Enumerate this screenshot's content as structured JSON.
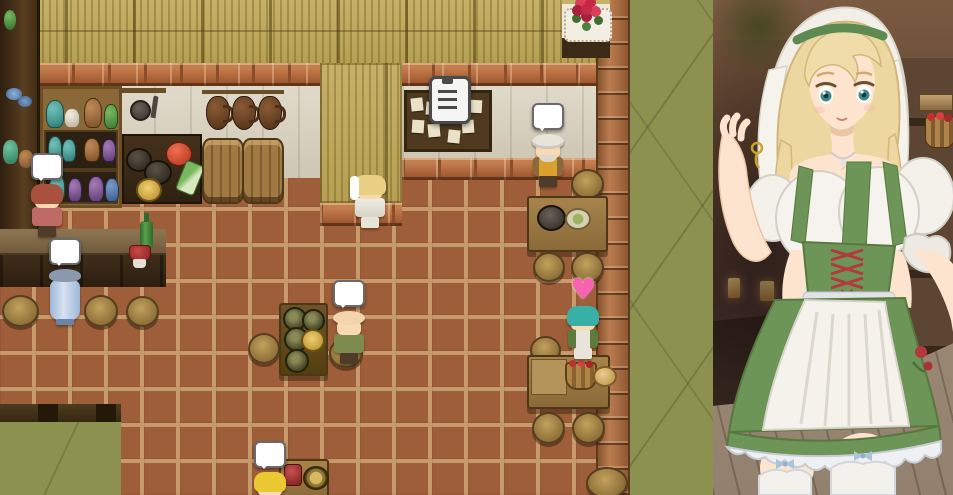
{
  "scene": {
    "description": "RPG Maker style tavern interior map with anime barmaid portrait overlay on the right",
    "viewport": {
      "width": 953,
      "height": 495
    }
  },
  "palette": {
    "floor": "#9e5e39",
    "floor-grout": "#c79a6b",
    "green-area": "#8d914f",
    "straw": "#c6b168",
    "brick-dark": "#8a4e2c",
    "bubble-fill": "#ffffff",
    "bubble-border": "#6a6a6a",
    "heart": "#f763ae",
    "portrait-bg-top": "#7a5a40",
    "portrait-bg-mid": "#46302a",
    "portrait-floor": "#93816f"
  },
  "indicators": {
    "heart_glyph": "♥",
    "speech_bubble_count": 5,
    "heart_count": 1
  },
  "characters": [
    {
      "id": "shopkeeper",
      "desc": "red-haired shopkeeper by the wall shelves",
      "hair": "#a9513f",
      "outfit": "#bf6a64",
      "indicator": "speech-bubble"
    },
    {
      "id": "blue-patron",
      "desc": "patron in light blue robe standing at the bar counter",
      "hair": "#8a9aac",
      "outfit": "#9cb6d8",
      "indicator": "speech-bubble"
    },
    {
      "id": "player-maid",
      "desc": "blonde maid player character with white veil",
      "hair": "#e9d084",
      "outfit": "#efece3",
      "indicator": "none"
    },
    {
      "id": "old-man",
      "desc": "old man with white turban and yellow vest at dining table",
      "hair": "#e9e5da",
      "outfit": "#d9a02e",
      "indicator": "speech-bubble"
    },
    {
      "id": "bald-patron",
      "desc": "bald patron in green sitting at keg table",
      "hair": "#f0cfa6",
      "outfit": "#7d8c4e",
      "indicator": "speech-bubble"
    },
    {
      "id": "teal-adventurer",
      "desc": "teal-haired adventurer in green armor with apron",
      "hair": "#39b0a6",
      "outfit": "#5d7c3c",
      "indicator": "heart"
    },
    {
      "id": "blonde-kid",
      "desc": "blonde child in red at bottom table",
      "hair": "#e9c832",
      "outfit": "#c24242",
      "indicator": "speech-bubble"
    }
  ],
  "map_props": [
    "bulletin-board",
    "quest-note-icon",
    "rose-bouquet-table",
    "bar-counter",
    "wine-bottle",
    "red-cup",
    "wooden-stools",
    "dining-table-with-pot-and-bowl",
    "keg-table-with-gold-plate",
    "table-with-apple-basket-and-bread",
    "table-with-mug-and-plate",
    "storage-barrels",
    "hanging-jugs",
    "pottery-cabinet",
    "wall-shelf-with-plates",
    "vegetable-crate",
    "kitchen-utensils",
    "brick-pillar",
    "straw-wall-panels"
  ],
  "portrait": {
    "character": "tavern barmaid",
    "hair": "blonde",
    "eyes": "teal green",
    "headwear": "white veil with green headband",
    "outfit": "green dirndl dress, white off-shoulder blouse, red corset lacing, white apron",
    "legwear": "white thigh-high stockings with blue bows",
    "background": "blurred tavern shelf with apple basket, bottles and warm window lights"
  }
}
